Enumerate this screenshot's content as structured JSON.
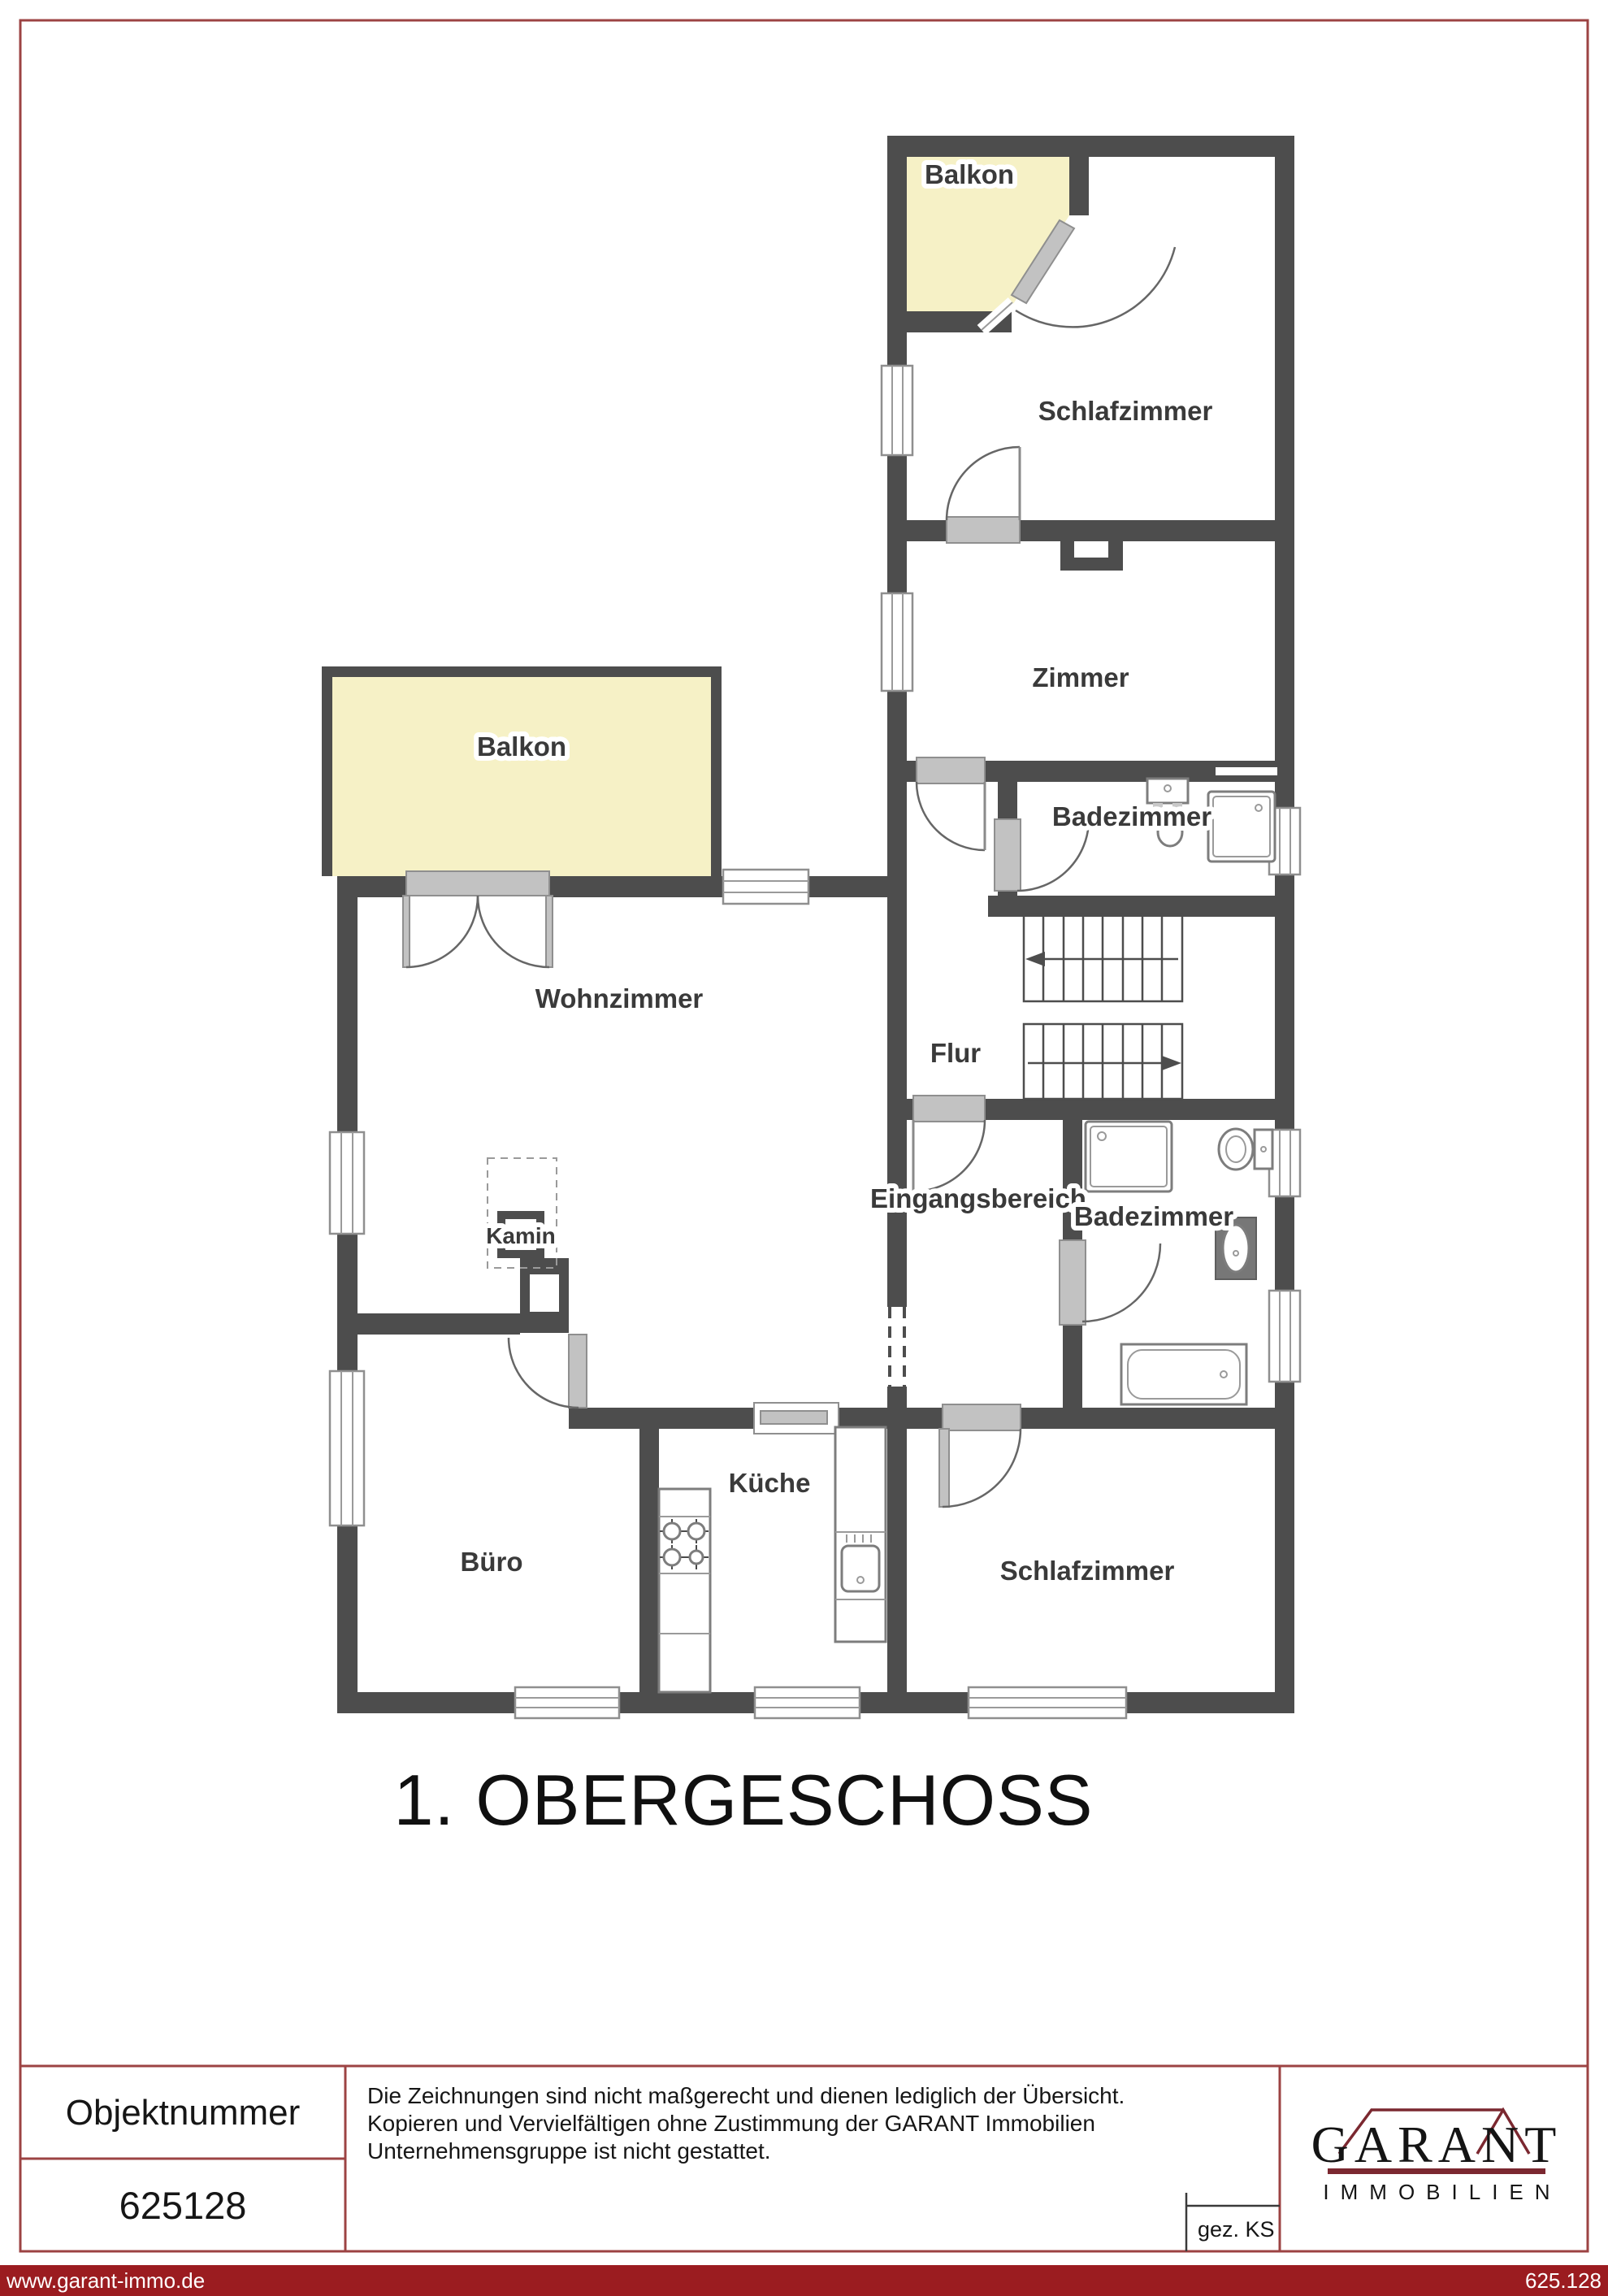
{
  "page": {
    "floor_title": "1. OBERGESCHOSS"
  },
  "plan": {
    "rooms": [
      {
        "id": "balkon-top",
        "label": "Balkon"
      },
      {
        "id": "schlafzimmer-top",
        "label": "Schlafzimmer"
      },
      {
        "id": "zimmer",
        "label": "Zimmer"
      },
      {
        "id": "badezimmer-upper",
        "label": "Badezimmer"
      },
      {
        "id": "flur",
        "label": "Flur"
      },
      {
        "id": "balkon-left",
        "label": "Balkon"
      },
      {
        "id": "wohnzimmer",
        "label": "Wohnzimmer"
      },
      {
        "id": "kamin",
        "label": "Kamin"
      },
      {
        "id": "eingangsbereich",
        "label": "Eingangsbereich"
      },
      {
        "id": "badezimmer-lower",
        "label": "Badezimmer"
      },
      {
        "id": "buero",
        "label": "Büro"
      },
      {
        "id": "kueche",
        "label": "Küche"
      },
      {
        "id": "schlafzimmer-bottom",
        "label": "Schlafzimmer"
      }
    ],
    "icons": [
      "stairs-icon",
      "door-icon",
      "window-icon",
      "shower-icon",
      "toilet-icon",
      "sink-icon",
      "bathtub-icon",
      "stove-icon",
      "kitchen-sink-icon",
      "fireplace-icon",
      "stair-direction-arrow-icon"
    ],
    "colors": {
      "wall": "#4d4d4d",
      "balcony_fill": "#f6f1c6",
      "door_sill": "#c2c2c2",
      "window_frame": "#8f8f8f"
    }
  },
  "footer": {
    "object_number_label": "Objektnummer",
    "object_number_value": "625128",
    "disclaimer_lines": [
      "Die Zeichnungen sind nicht maßgerecht und dienen lediglich der Übersicht.",
      "Kopieren und Vervielfältigen ohne Zustimmung der GARANT Immobilien",
      "Unternehmensgruppe ist nicht gestattet."
    ],
    "drawn_by": "gez. KS",
    "logo": {
      "name": "GARANT",
      "subtitle": "IMMOBILIEN",
      "accent_color": "#7b2830"
    },
    "bottom_bar": {
      "url": "www.garant-immo.de",
      "number": "625.128",
      "color": "#9b1c20"
    }
  }
}
